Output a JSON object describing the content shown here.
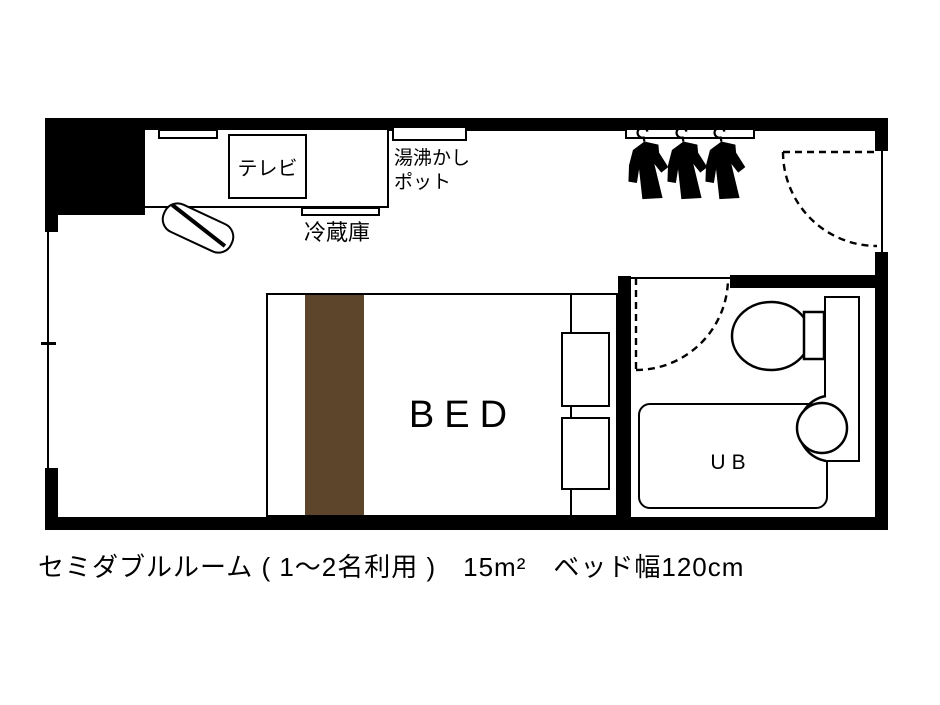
{
  "plan": {
    "caption": "セミダブルルーム ( 1～2名利用 )　15m²　ベッド幅120cm",
    "labels": {
      "tv": "テレビ",
      "kettle": "湯沸かし\nポット",
      "fridge": "冷蔵庫",
      "bed": "BED",
      "unit_bath": "UB"
    },
    "colors": {
      "wall": "#000000",
      "bed_accent": "#5d452c",
      "background": "#ffffff"
    }
  }
}
